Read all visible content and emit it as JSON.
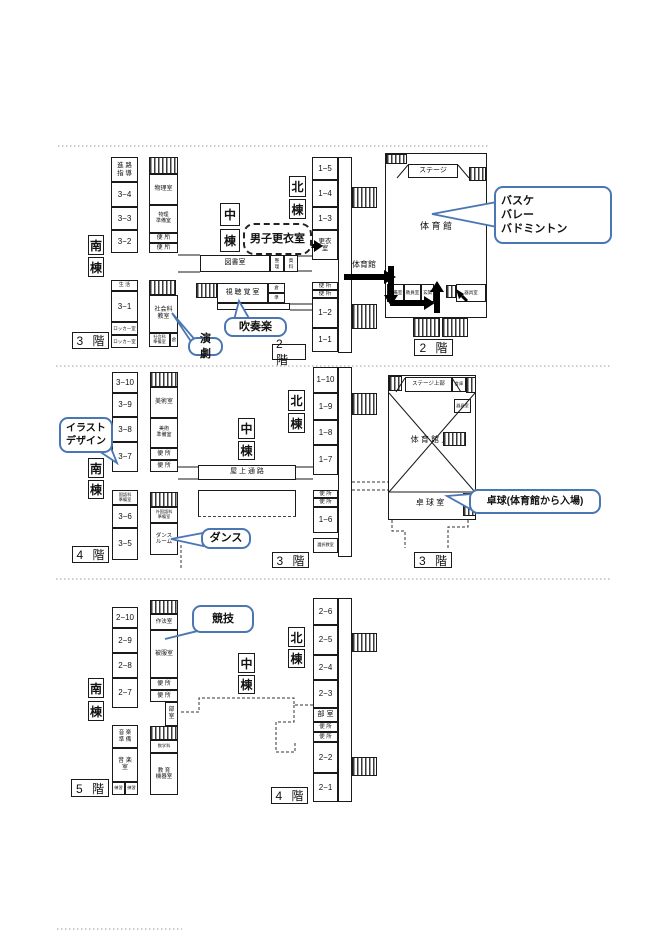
{
  "colors": {
    "line": "#1a1a1a",
    "callout_border": "#4a77b4",
    "arrow": "#000000"
  },
  "s1": {
    "south": {
      "building": [
        "南",
        "棟"
      ],
      "floor": "3 階",
      "col1": [
        "進 路\n指 導",
        "3−4",
        "3−3",
        "3−2",
        "生 活",
        "3−1",
        "ロッカー室",
        "ロッカー室"
      ],
      "col2": [
        "物理室",
        "物理\n準備室",
        "便 所",
        "便 所",
        "社会科\n教室",
        "社会科\n準備室",
        "倉"
      ]
    },
    "center": {
      "building": [
        "中",
        "棟"
      ],
      "floor": "2 階",
      "rooms": [
        "図書室",
        "整\n理",
        "資\n料",
        "視 聴 覚 室",
        "倉",
        "準"
      ]
    },
    "north": {
      "building": [
        "北",
        "棟"
      ],
      "route_label": "体育館",
      "rooms": [
        "1−5",
        "1−4",
        "1−3",
        "更衣\n室",
        "便 所",
        "便 所",
        "1−2",
        "1−1"
      ]
    },
    "gym": {
      "floor": "2 階",
      "stage": "ステージ",
      "name": "体 育 館",
      "rooms": [
        "準備室",
        "教員室",
        "玄関",
        "器具室"
      ]
    },
    "callouts": {
      "danshi": "男子更衣室",
      "suisogaku": "吹奏楽",
      "engeki": "演劇",
      "sports": "バスケ\nバレー\nバドミントン"
    }
  },
  "s2": {
    "south": {
      "building": [
        "南",
        "棟"
      ],
      "floor": "4 階",
      "col1": [
        "3−10",
        "3−9",
        "3−8",
        "3−7",
        "国語科\n準備室",
        "3−6",
        "3−5"
      ],
      "col2": [
        "美術室",
        "美術\n準備室",
        "便 所",
        "便 所",
        "外国語科\n準備室",
        "ダンス\nルーム"
      ]
    },
    "center": {
      "building": [
        "中",
        "棟"
      ],
      "passage": "屋 上 通 路"
    },
    "north": {
      "building": [
        "北",
        "棟"
      ],
      "floor": "3 階",
      "rooms": [
        "1−10",
        "1−9",
        "1−8",
        "1−7",
        "便 所",
        "便 所",
        "1−6",
        "選択教室"
      ]
    },
    "gym": {
      "floor": "3 階",
      "stage_upper": "ステージ上部",
      "storage": "倉庫",
      "kigushitsu": "器具室",
      "name": "体 育 館 上",
      "takkyu": "卓 球 室"
    },
    "callouts": {
      "illust": "イラスト\nデザイン",
      "dance": "ダンス",
      "takkyu": "卓球(体育館から入場)"
    }
  },
  "s3": {
    "south": {
      "building": [
        "南",
        "棟"
      ],
      "floor": "5 階",
      "col1": [
        "2−10",
        "2−9",
        "2−8",
        "2−7",
        "音 楽\n準 備",
        "音 楽\n室",
        "練習",
        "練習"
      ],
      "col2": [
        "作法室",
        "被服室",
        "便 所",
        "便 所",
        "部\n室",
        "数学科",
        "教 育\n機器室"
      ]
    },
    "center": {
      "building": [
        "中",
        "棟"
      ]
    },
    "north": {
      "building": [
        "北",
        "棟"
      ],
      "floor": "4 階",
      "rooms": [
        "2−6",
        "2−5",
        "2−4",
        "2−3",
        "部 室",
        "便 所",
        "便 所",
        "2−2",
        "2−1"
      ]
    },
    "callouts": {
      "kyogi": "競技"
    }
  }
}
